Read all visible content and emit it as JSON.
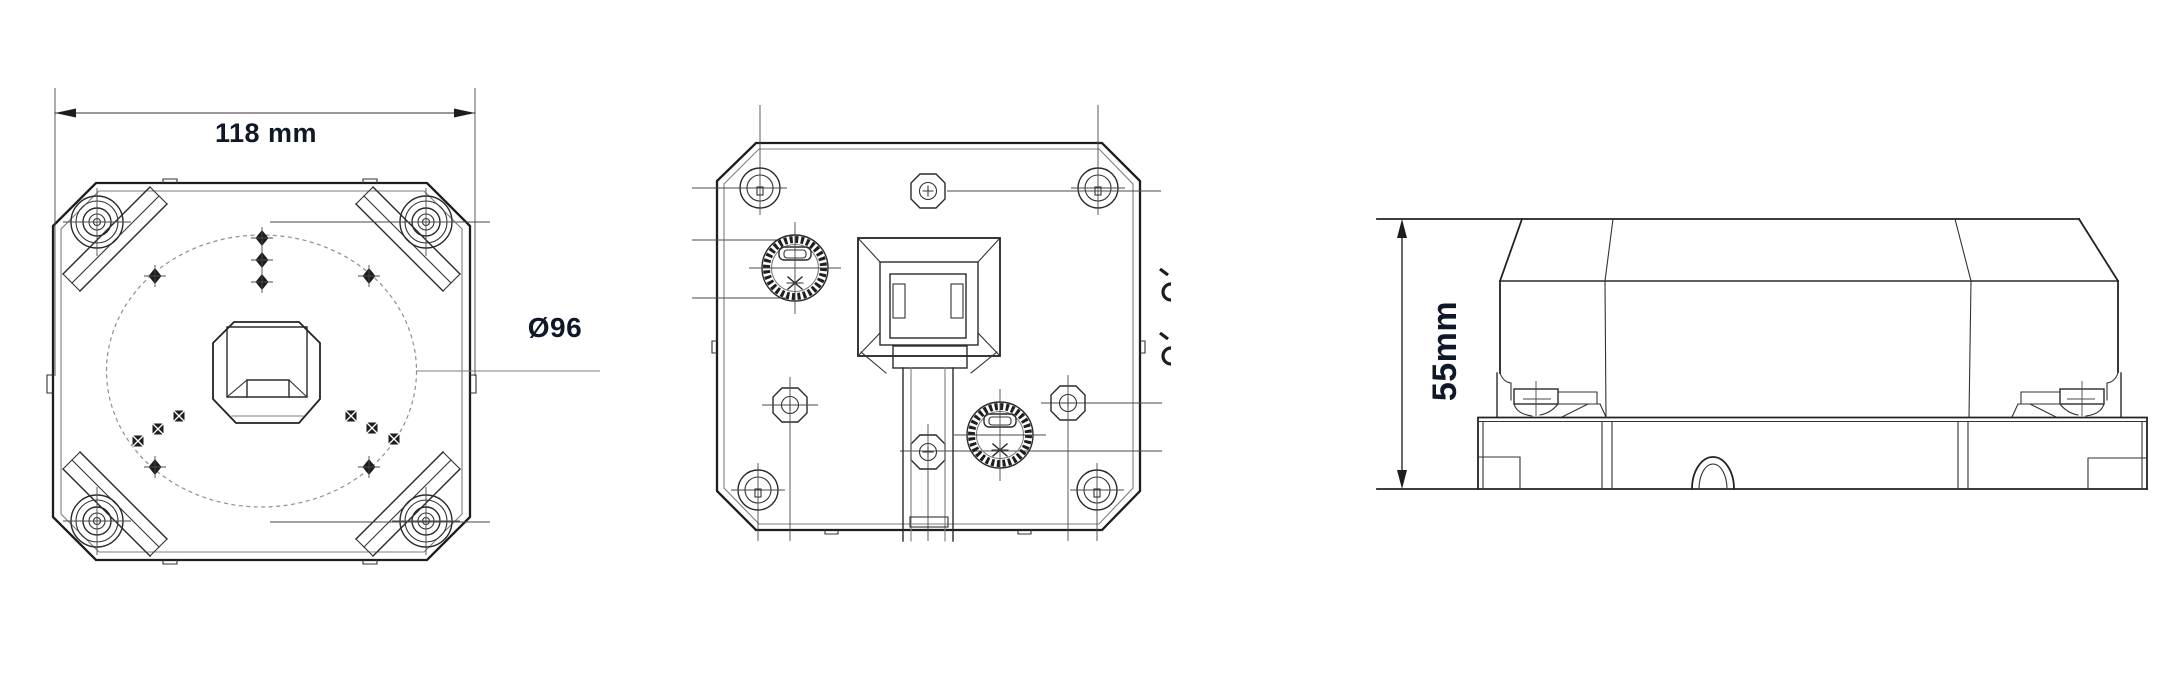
{
  "page": {
    "background": "#ffffff"
  },
  "colors": {
    "line": "#1d1d1d",
    "thin_line": "#4a4a4a",
    "dashed_circle": "#8f8f8f",
    "dimension_text": "#101828"
  },
  "drawing": {
    "front_view": {
      "width_dimension_label": "118 mm",
      "diameter_label": "Ø96"
    },
    "rear_view": {},
    "side_view": {
      "height_dimension_label": "55mm"
    }
  }
}
